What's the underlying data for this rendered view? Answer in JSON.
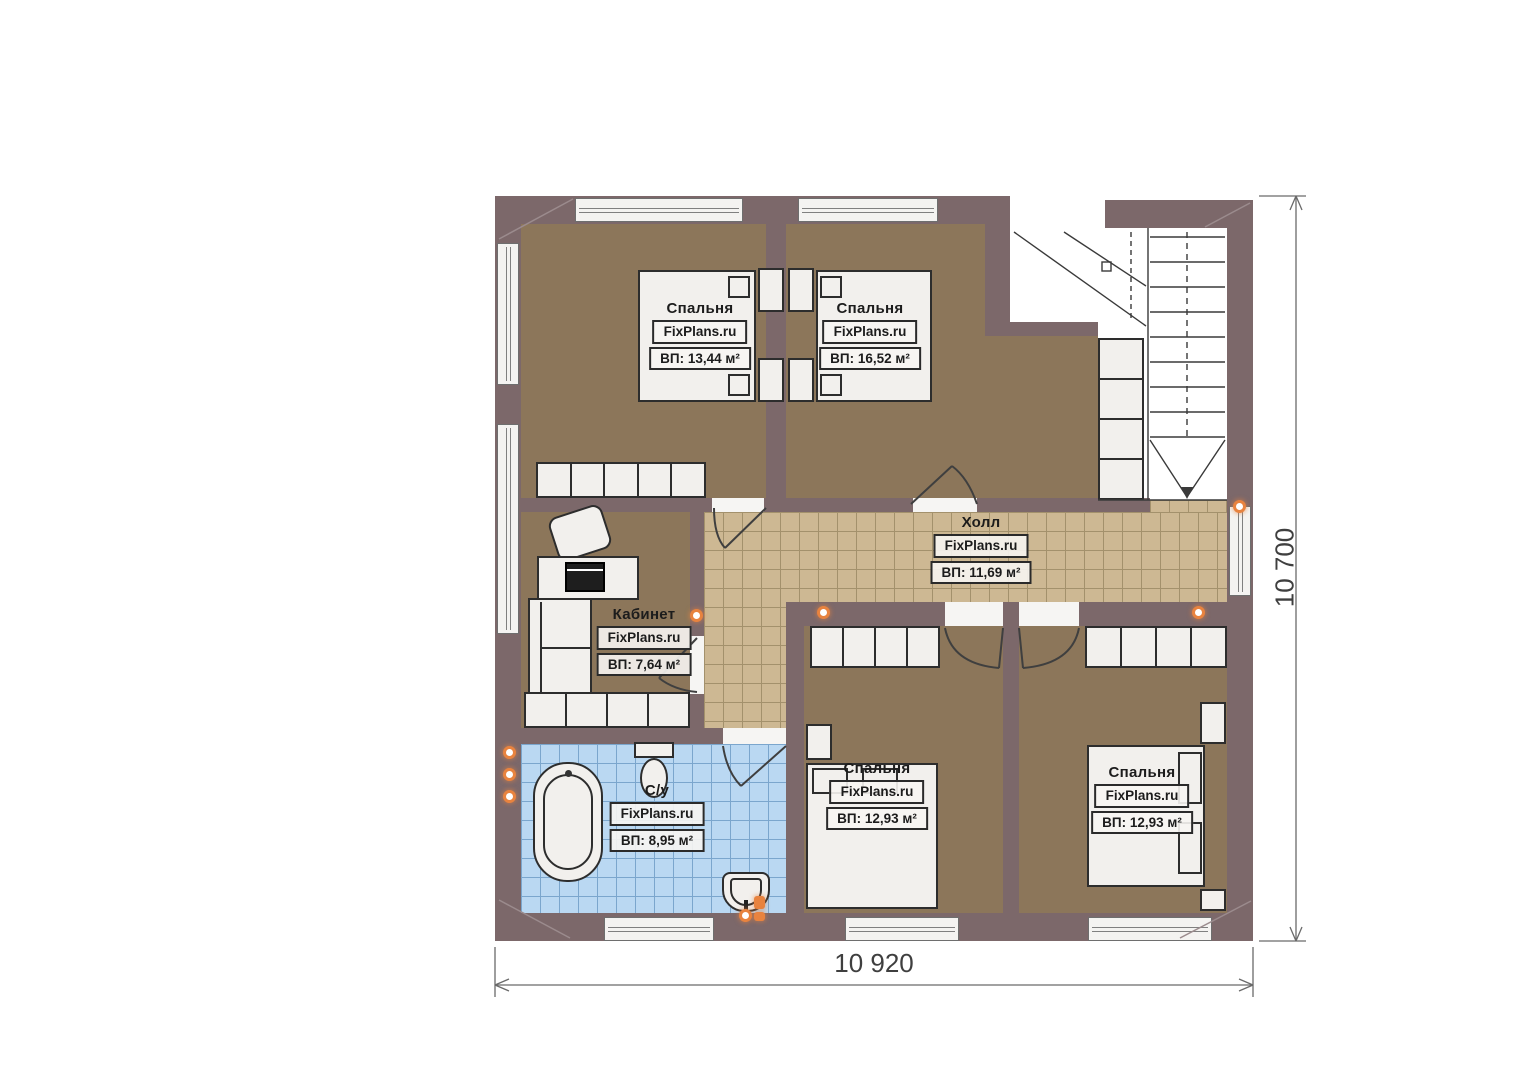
{
  "plan": {
    "watermark": "FixPlans.ru",
    "rooms": {
      "bedroom1": {
        "name": "Спальня",
        "area": "ВП: 13,44 м²"
      },
      "bedroom2": {
        "name": "Спальня",
        "area": "ВП: 16,52 м²"
      },
      "hall": {
        "name": "Холл",
        "area": "ВП: 11,69 м²"
      },
      "office": {
        "name": "Кабинет",
        "area": "ВП: 7,64 м²"
      },
      "bathroom": {
        "name": "С/у",
        "area": "ВП: 8,95 м²"
      },
      "bedroom3": {
        "name": "Спальня",
        "area": "ВП: 12,93 м²"
      },
      "bedroom4": {
        "name": "Спальня",
        "area": "ВП: 12,93 м²"
      }
    },
    "dimensions": {
      "width": "10 920",
      "height": "10 700"
    },
    "colors": {
      "wall": "#7c686a",
      "bedroom_floor": "#8c765a",
      "hall_tile": "#cdb893",
      "bath_tile": "#bad8f2",
      "accent_dot": "#e8833f"
    }
  }
}
